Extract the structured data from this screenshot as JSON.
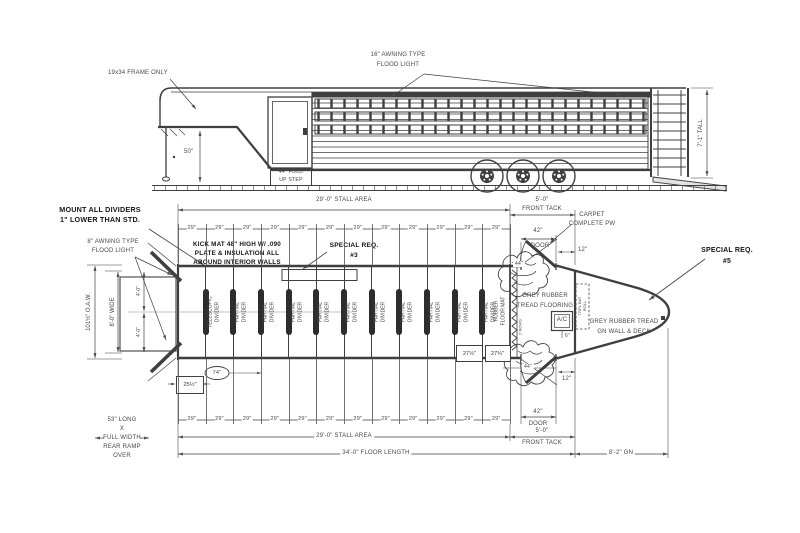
{
  "elev": {
    "frame_note": "19x34 FRAME ONLY",
    "flood_note": [
      "16\" AWNING TYPE",
      "FLOOD LIGHT"
    ],
    "dim50": "50\"",
    "step": [
      "44\" FOLD",
      "UP STEP"
    ],
    "tall": "7'-1\" TALL"
  },
  "plan": {
    "mount": [
      "MOUNT ALL DIVIDERS",
      "1\" LOWER THAN STD."
    ],
    "flood8": [
      "8\" AWNING TYPE",
      "FLOOD LIGHT"
    ],
    "kick": [
      "KICK MAT 48\" HIGH W/ .090",
      "PLATE & INSULATION ALL",
      "AROUND INTERIOR WALLS"
    ],
    "sp3": [
      "SPECIAL REQ.",
      "#3"
    ],
    "sp5": [
      "SPECIAL REQ.",
      "#5"
    ],
    "carpet": [
      "CARPET",
      "COMPLETE PW"
    ],
    "grey_floor": [
      "GREY RUBBER",
      "TREAD FLOORING"
    ],
    "grey_gn": [
      "GREY RUBBER TREAD",
      "GN WALL & DECK"
    ],
    "mat": [
      "RUBBER",
      "FLOOR MAT"
    ],
    "rows": "2 ROWS",
    "ac": "A/C",
    "ac6": "6\"",
    "rack": [
      "TRPL BAT",
      "ROLL"
    ],
    "ramp": [
      "53\" LONG",
      "X",
      "FULL WIDTH",
      "REAR RAMP",
      "OVER"
    ],
    "dividers": [
      [
        "TELESCOPIC",
        "DIVIDER"
      ],
      [
        "PARTIAL",
        "DIVIDER"
      ],
      [
        "PARTIAL",
        "DIVIDER"
      ],
      [
        "PARTIAL",
        "DIVIDER"
      ],
      [
        "PARTIAL",
        "DIVIDER"
      ],
      [
        "PARTIAL",
        "DIVIDER"
      ],
      [
        "PARTIAL",
        "DIVIDER"
      ],
      [
        "PARTIAL",
        "DIVIDER"
      ],
      [
        "PARTIAL",
        "DIVIDER"
      ],
      [
        "PARTIAL",
        "DIVIDER"
      ],
      [
        "PARTIAL",
        "DIVIDER"
      ]
    ]
  },
  "dims": {
    "stall": "29'-0\" STALL AREA",
    "tack": [
      "5'-0\"",
      "FRONT TACK"
    ],
    "floor": "34'-0\" FLOOR LENGTH",
    "gn": "8'-2\" GN",
    "oaw": "101½\" O.A.W.",
    "wide": "8'-0\" WIDE",
    "half": "4'-0\"",
    "door": [
      "42\"",
      "DOOR"
    ],
    "d12": "12\"",
    "d44": "44\"",
    "d25": "25½\"",
    "d74": "74\"",
    "d27a": "27½\"",
    "d27b": "27¾\"",
    "segs_top": [
      "29\"",
      "29\"",
      "29\"",
      "29\"",
      "29\"",
      "29\"",
      "29\"",
      "29\"",
      "29\"",
      "29\"",
      "29\"",
      "29\""
    ],
    "segs_bot": [
      "29\"",
      "29\"",
      "29\"",
      "29\"",
      "29\"",
      "29\"",
      "29\"",
      "29\"",
      "29\"",
      "29\"",
      "29\"",
      "29\""
    ]
  },
  "colors": {
    "line": "#3f3f3f",
    "text": "#474747",
    "bold_text": "#141414"
  }
}
